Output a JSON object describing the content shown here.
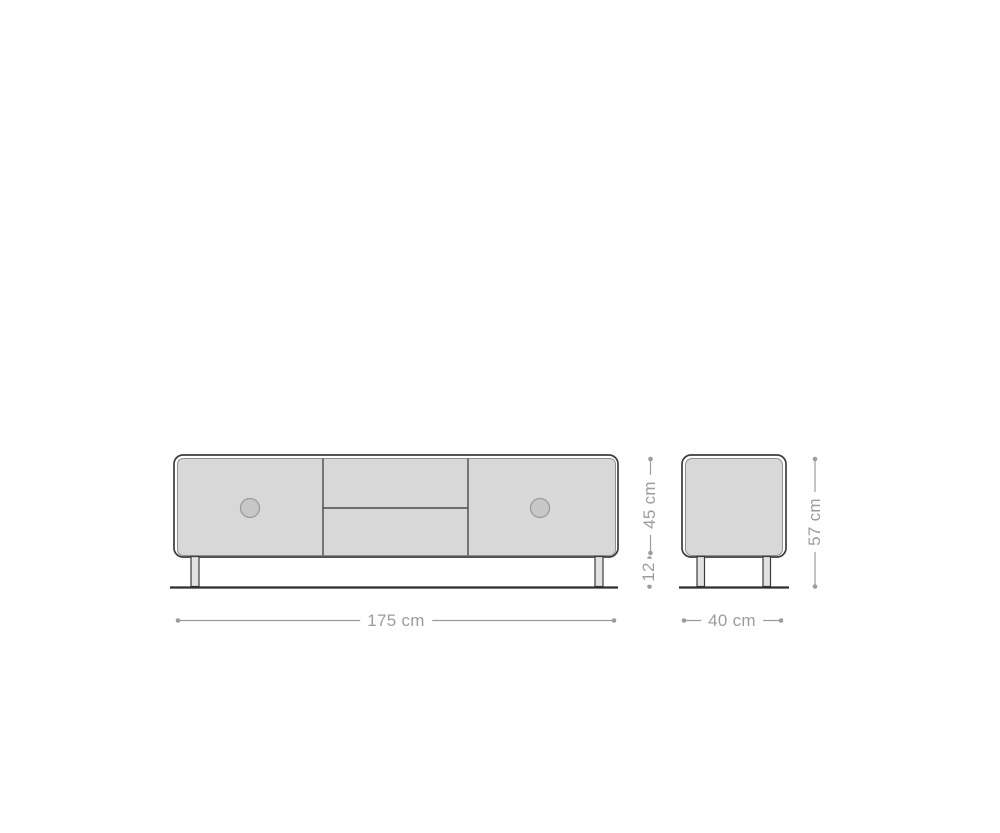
{
  "drawing": {
    "type": "furniture-dimension-diagram",
    "subject": "Lowboard / TV stand with two doors, two drawers and four legs, shown in front view and side view with measurements",
    "views": {
      "front": {
        "name": "front-view"
      },
      "side": {
        "name": "side-view"
      }
    },
    "dimensions": {
      "width": {
        "label": "175 cm"
      },
      "depth": {
        "label": "40 cm"
      },
      "body_height": {
        "label": "45 cm"
      },
      "leg_height": {
        "label": "12"
      },
      "total_height": {
        "label": "57 cm"
      }
    },
    "colors": {
      "background": "#ffffff",
      "body_outline": "#3c3c3c",
      "panel_fill": "#d8d8d8",
      "panel_stroke": "#8f8f8f",
      "divider": "#4a4a4a",
      "handle_fill": "#c7c7c7",
      "handle_stroke": "#9c9c9c",
      "leg_fill": "#e2e2e2",
      "ground_line": "#2e2e2e",
      "dimension": "#9c9c9c"
    }
  }
}
